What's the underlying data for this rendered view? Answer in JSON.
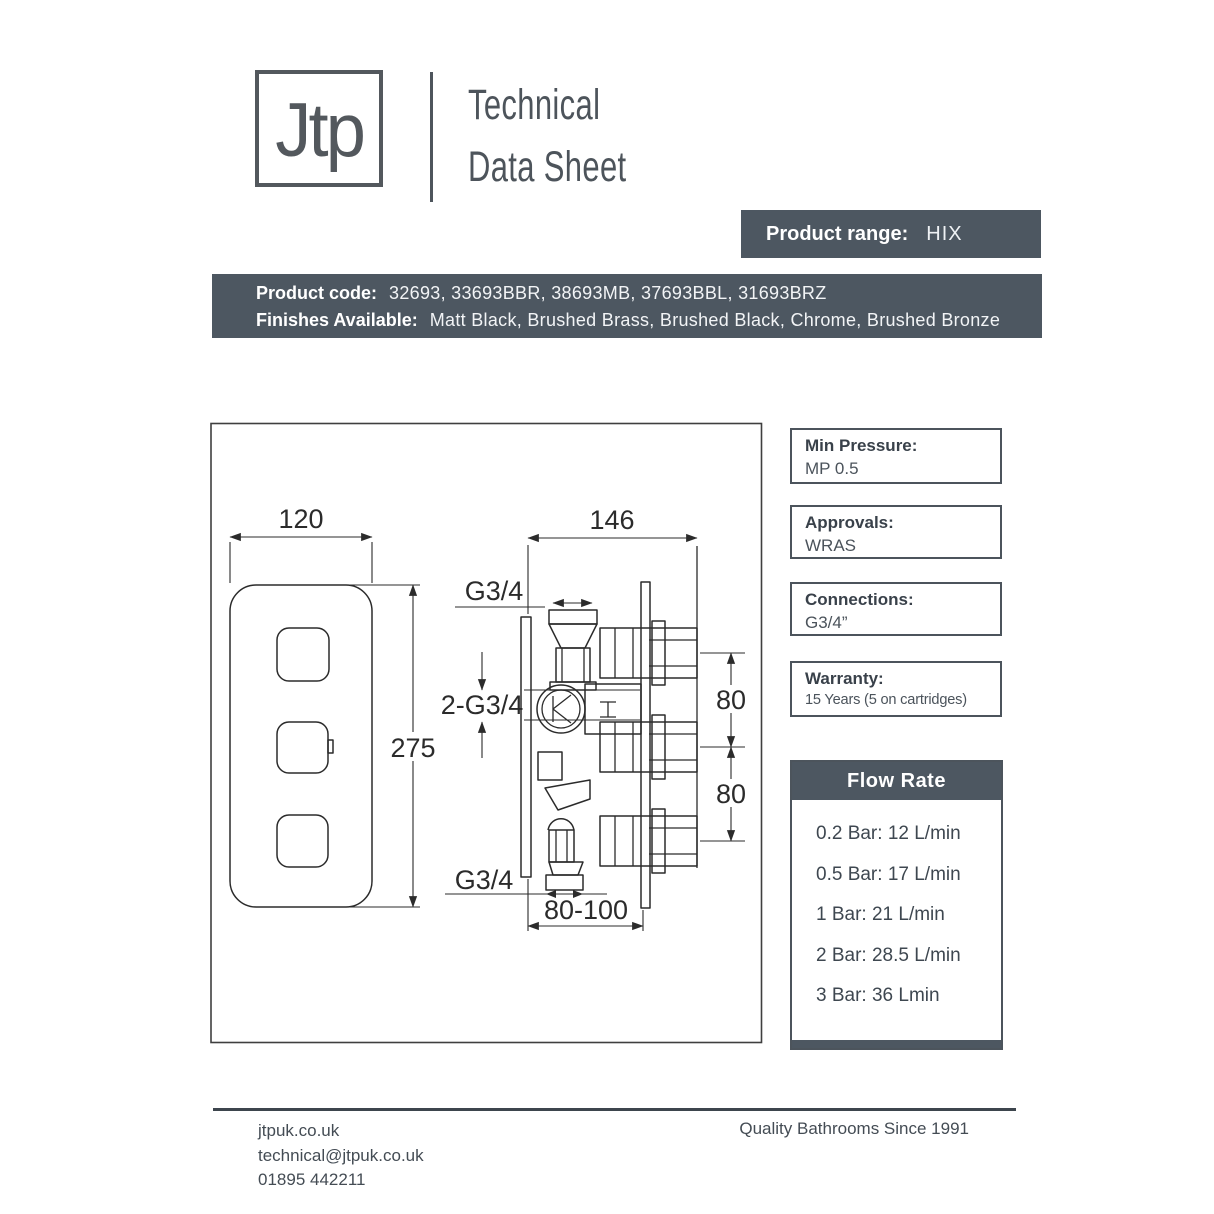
{
  "brand": {
    "logo_text": "Jtp",
    "doc_title_line1": "Technical",
    "doc_title_line2": "Data Sheet"
  },
  "product": {
    "range_label": "Product range:",
    "range_value": "HIX",
    "code_label": "Product code:",
    "code_value": "32693, 33693BBR, 38693MB, 37693BBL, 31693BRZ",
    "finishes_label": "Finishes Available:",
    "finishes_value": "Matt Black, Brushed Brass, Brushed Black, Chrome, Brushed Bronze"
  },
  "specs": [
    {
      "label": "Min Pressure:",
      "value": "MP 0.5"
    },
    {
      "label": "Approvals:",
      "value": "WRAS"
    },
    {
      "label": "Connections:",
      "value": "G3/4”"
    },
    {
      "label": "Warranty:",
      "value": "15 Years (5 on cartridges)"
    }
  ],
  "flow_rate": {
    "title": "Flow Rate",
    "rows": [
      "0.2 Bar: 12 L/min",
      "0.5 Bar: 17 L/min",
      "1 Bar: 21 L/min",
      "2 Bar: 28.5 L/min",
      "3 Bar: 36 Lmin"
    ]
  },
  "drawing": {
    "dim_width": "120",
    "dim_height": "275",
    "dim_depth": "146",
    "dim_port_top": "G3/4",
    "dim_ports_mid": "2-G3/4",
    "dim_port_bottom": "G3/4",
    "dim_spacing_top": "80",
    "dim_spacing_bottom": "80",
    "dim_mount_depth": "80-100"
  },
  "footer": {
    "website": "jtpuk.co.uk",
    "email": "technical@jtpuk.co.uk",
    "phone": "01895 442211",
    "tagline": "Quality Bathrooms Since 1991"
  },
  "colors": {
    "slate": "#4d5761",
    "line": "#2b2b2b"
  }
}
